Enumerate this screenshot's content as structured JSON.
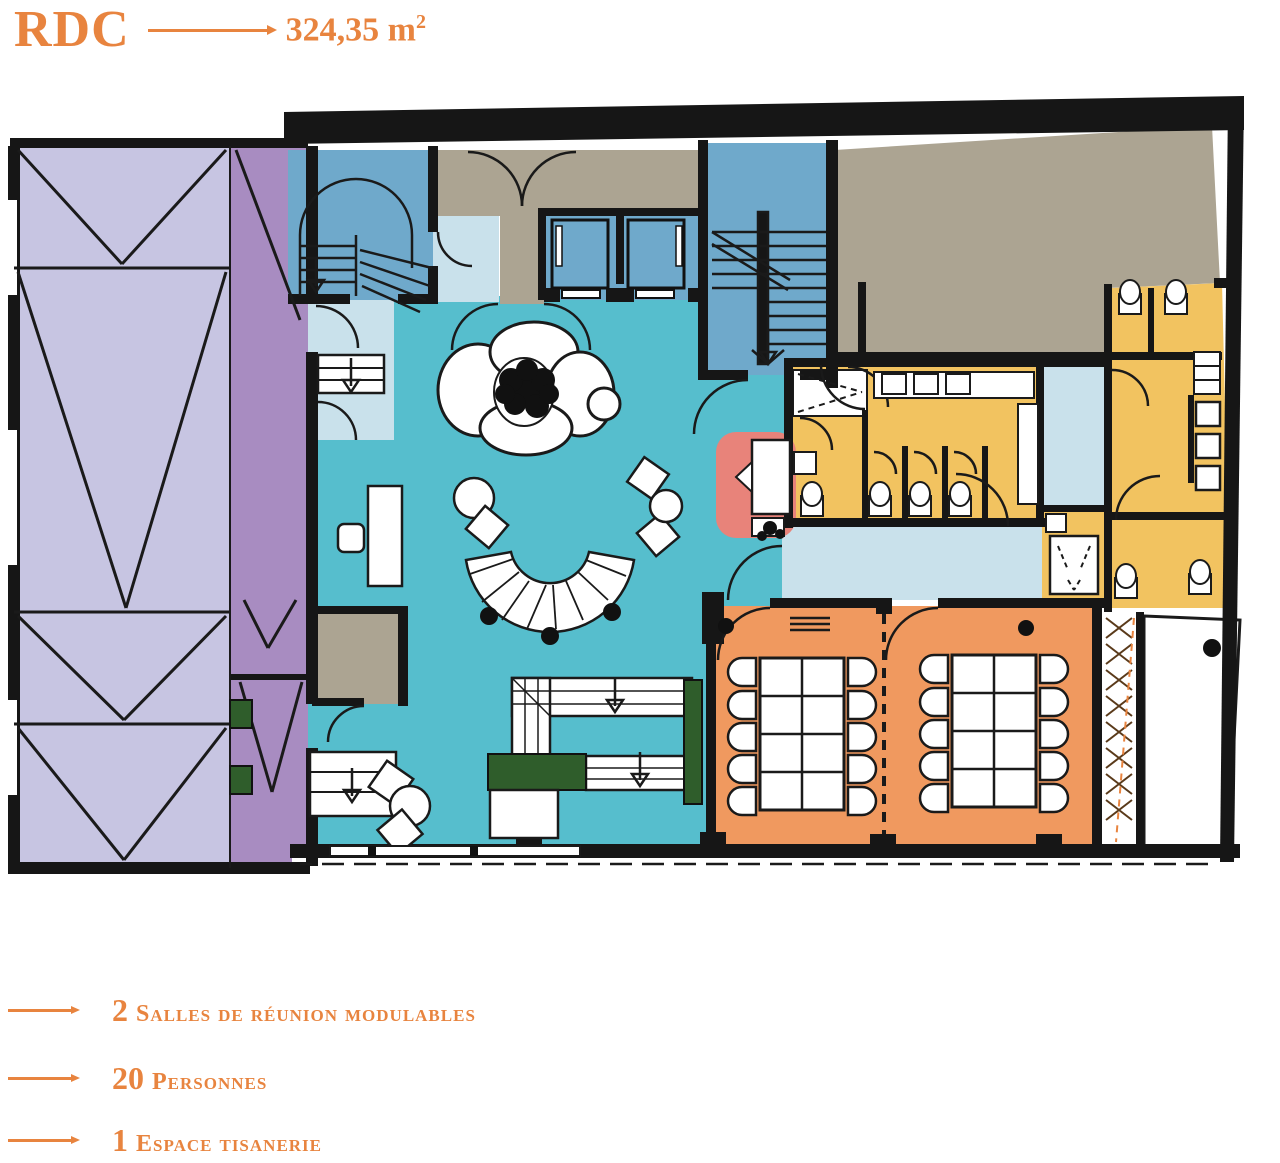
{
  "header": {
    "title": "RDC",
    "area_value": "324,35",
    "area_unit": "m",
    "area_sup": "2"
  },
  "legend": {
    "items": [
      {
        "qty": "2",
        "label": "Salles de réunion modulables"
      },
      {
        "qty": "20",
        "label": "Personnes"
      },
      {
        "qty": "1",
        "label": "Espace tisanerie"
      }
    ]
  },
  "colors": {
    "accent": "#E8843F",
    "wall": "#161616",
    "teal": "#56BECD",
    "light_blue": "#C9E1EB",
    "medium_blue": "#6FA9CB",
    "lavender": "#C7C5E2",
    "purple": "#A88CC1",
    "taupe": "#ACA492",
    "yellow": "#F2C360",
    "orange_room": "#F0995F",
    "salmon": "#E8837A",
    "green": "#2F5D2B"
  }
}
